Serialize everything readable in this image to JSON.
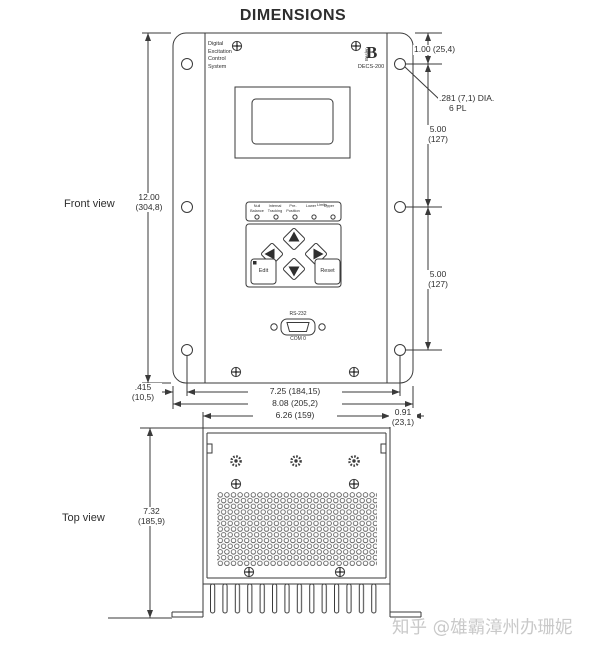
{
  "page": {
    "title": "DIMENSIONS",
    "background": "#ffffff",
    "line_color": "#3a3a3a"
  },
  "front_view": {
    "label": "Front view",
    "panel": {
      "name_lines": [
        "Digital",
        "Excitation",
        "Control",
        "System"
      ],
      "brand_letter": "B",
      "brand_vertical": "Basler",
      "model": "DECS-200",
      "leds": {
        "cols": [
          [
            "Null",
            "Balance"
          ],
          [
            "Internal",
            "Tracking"
          ],
          [
            "Pre-",
            "Position"
          ],
          [
            "",
            "Lower"
          ],
          [
            "",
            "Upper"
          ]
        ],
        "limits": "Limits"
      },
      "edit_label": "Edit",
      "reset_label": "Reset",
      "port_top": "RS-232",
      "port_bottom": "COM 0"
    },
    "dims": {
      "height": {
        "in": "12.00",
        "mm": "(304,8)"
      },
      "top_to_hole": "1.00 (25,4)",
      "hole_note": [
        ".281 (7,1) DIA.",
        "6 PL"
      ],
      "spacing_upper": {
        "in": "5.00",
        "mm": "(127)"
      },
      "spacing_lower": {
        "in": "5.00",
        "mm": "(127)"
      },
      "edge_offset": {
        "in": ".415",
        "mm": "(10,5)"
      },
      "hole_span": "7.25 (184,15)",
      "overall_width": "8.08 (205,2)"
    }
  },
  "top_view": {
    "label": "Top view",
    "dims": {
      "depth": {
        "in": "7.32",
        "mm": "(185,9)"
      },
      "chassis_width": "6.26 (159)",
      "flange": {
        "in": "0.91",
        "mm": "(23,1)"
      }
    }
  },
  "watermark": {
    "text": "知乎 @雄霸漳州办珊妮"
  }
}
